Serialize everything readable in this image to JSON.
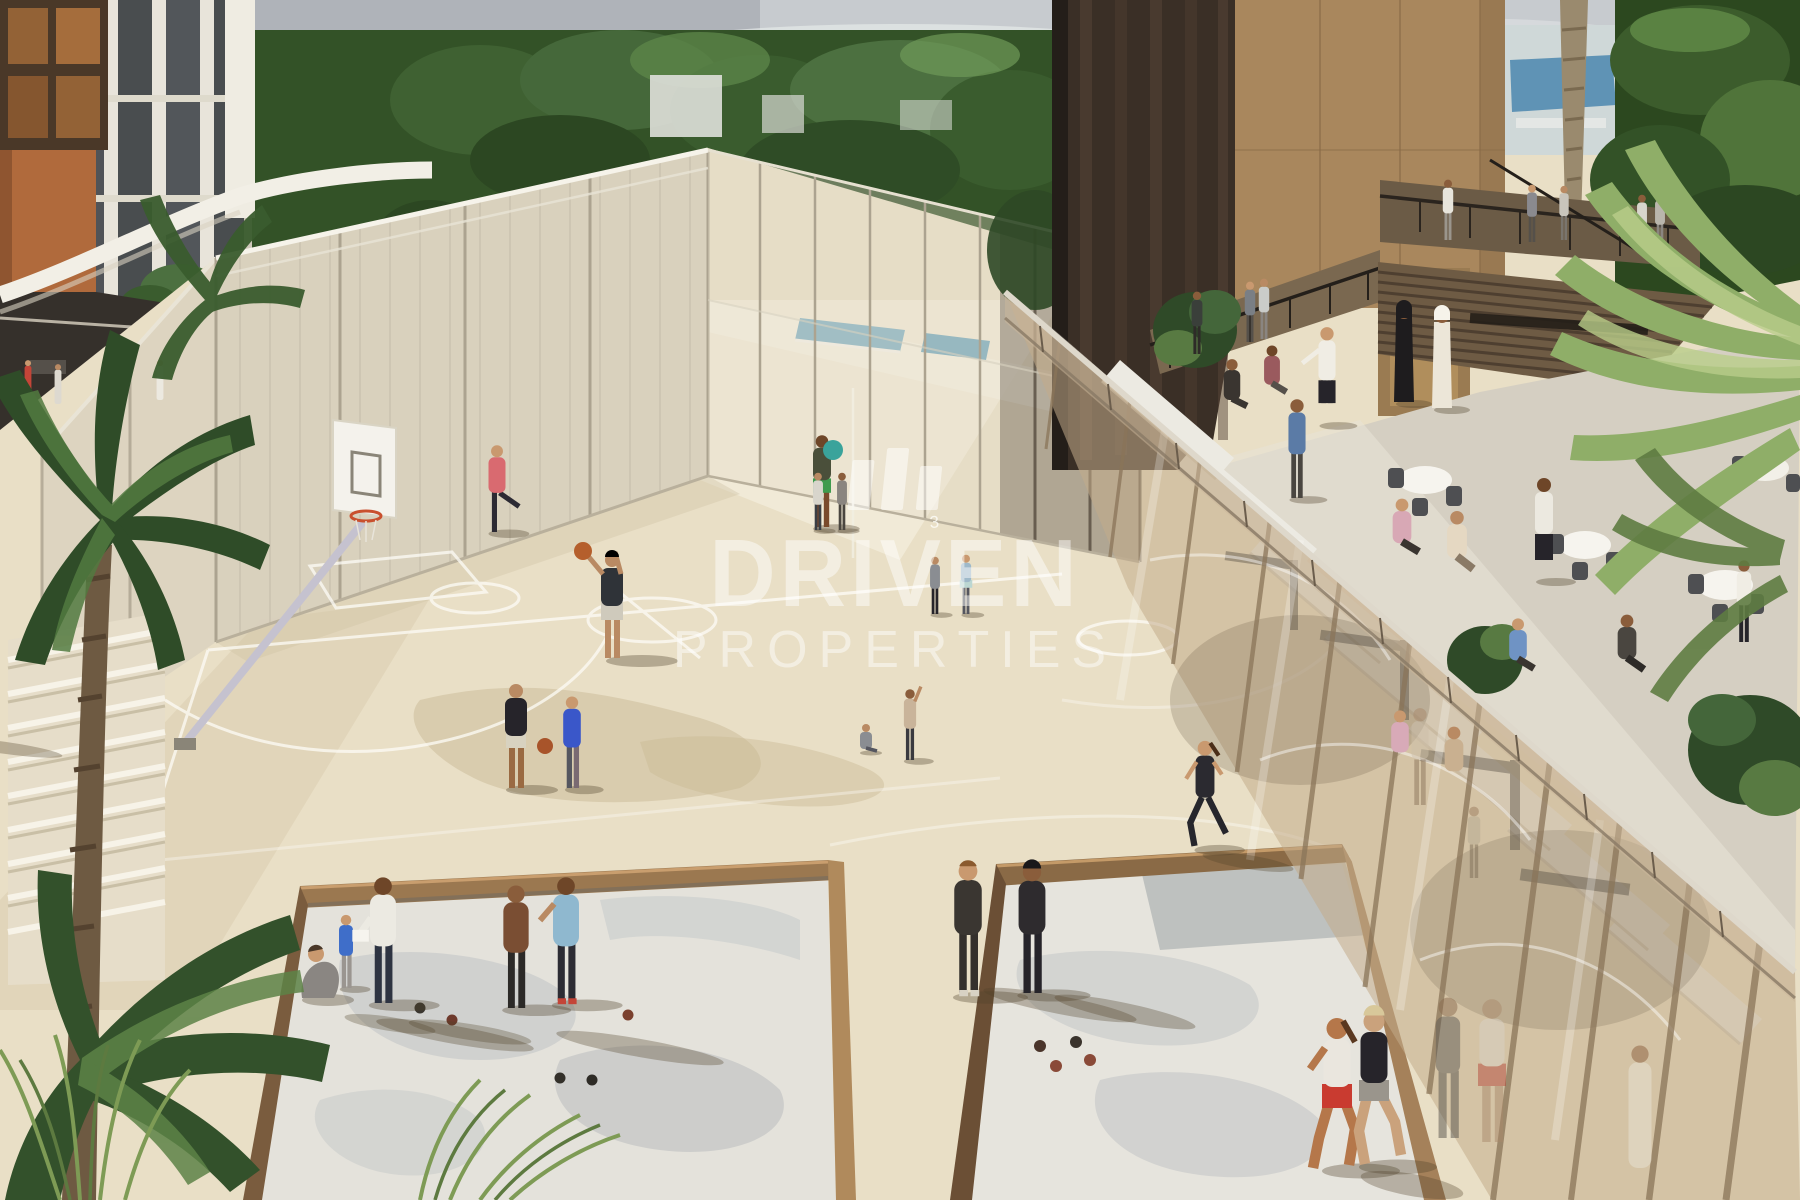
{
  "meta": {
    "type": "architectural-rendering",
    "subject": "residential development amenity deck with sports courts, petanque pits and restaurant terrace"
  },
  "watermark": {
    "logo": "driven-properties-bars-icon",
    "line1": "DRIVEN",
    "line2": "PROPERTIES",
    "color": "#ffffff",
    "opacity": 0.45
  },
  "scene": {
    "court_number": "3",
    "regions": {
      "background": [
        "sky",
        "tree-line",
        "left-residential-tower",
        "terracotta-wall",
        "rooftop-pool"
      ],
      "center": [
        "mesh-padel-courts",
        "basketball-court",
        "basketball-hoop",
        "curved-parapet"
      ],
      "foreground": [
        "petanque-sand-pit-1",
        "petanque-sand-pit-2",
        "jogging-path",
        "palm-trees",
        "ornamental-grass"
      ],
      "right": [
        "bronze-tower",
        "slatted-awning",
        "restaurant-terrace",
        "glass-balustrade",
        "glazed-gym-wall",
        "upper-walkway"
      ]
    },
    "people_estimate": {
      "basketball_court": 9,
      "petanque_pits": 7,
      "joggers": 3,
      "terrace_diners": 14,
      "walkways": 8,
      "behind_glass": 5,
      "far_terrace": 4
    },
    "palette": {
      "court": "#e9dfc6",
      "court_light": "#f4eedd",
      "court_shadow": "#cfc2a2",
      "sand": "#e4e2db",
      "sand_gray": "#b7bcc0",
      "mesh": "#d8d0bd",
      "fence_post": "#aca390",
      "bronze_dark": "#3a2f26",
      "bronze_light": "#a9875d",
      "glass_tint": "#c3ab8a",
      "greenery": "#335227",
      "palm": "#5d8347",
      "white_trim": "#f2efe6",
      "sky": "#c7cbcf",
      "awning": "#6e5b44",
      "terrace_floor": "#d5cfc2",
      "wood_rim": "#8a6847",
      "basketball": "#b55f2c",
      "pool_water": "#7fb0c4"
    }
  }
}
